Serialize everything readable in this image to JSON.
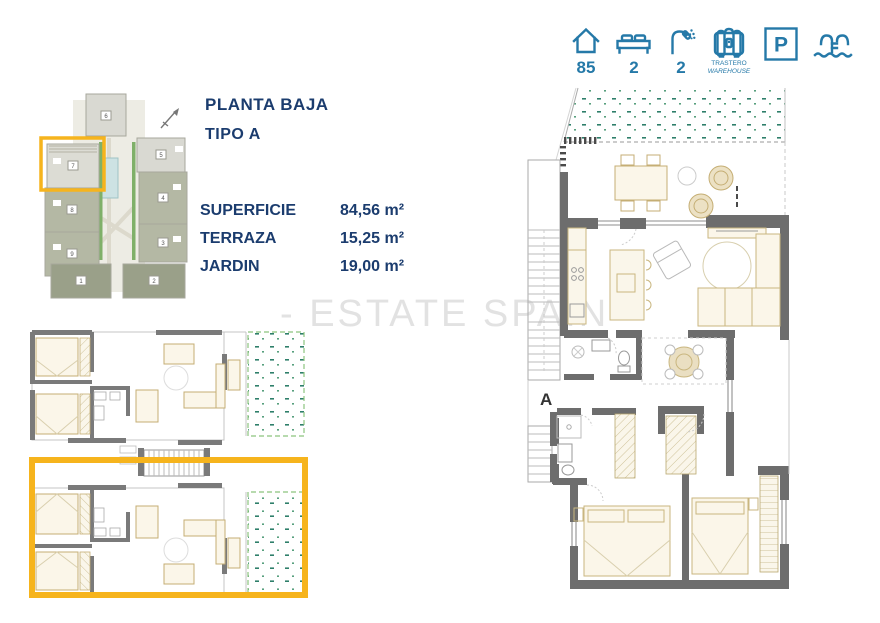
{
  "header": {
    "house_value": "85",
    "bed_value": "2",
    "shower_value": "2",
    "trastero_label_line1": "TRASTERO",
    "trastero_label_line2": "WAREHOUSE",
    "parking_letter": "P"
  },
  "title": {
    "line1": "PLANTA BAJA",
    "line2": "TIPO A"
  },
  "specs": [
    {
      "label": "SUPERFICIE",
      "value": "84,56 m²"
    },
    {
      "label": "TERRAZA",
      "value": "15,25 m²"
    },
    {
      "label": "JARDIN",
      "value": "19,00 m²"
    }
  ],
  "watermark": "- ESTATE SPAIN -",
  "main_plan": {
    "unit_label": "A"
  },
  "site_plan": {
    "building_numbers": [
      "1",
      "2",
      "3",
      "4",
      "5",
      "6",
      "7",
      "8",
      "9"
    ],
    "highlighted_building": "7"
  },
  "colors": {
    "navy": "#1b3c6e",
    "teal": "#2579a8",
    "accent_yellow": "#f6b41d",
    "wall_gray": "#6d6d6d",
    "furniture_tan": "#c5ae74",
    "garden_green": "#2e7f6a",
    "watermark_gray": "#e2e2e2"
  }
}
